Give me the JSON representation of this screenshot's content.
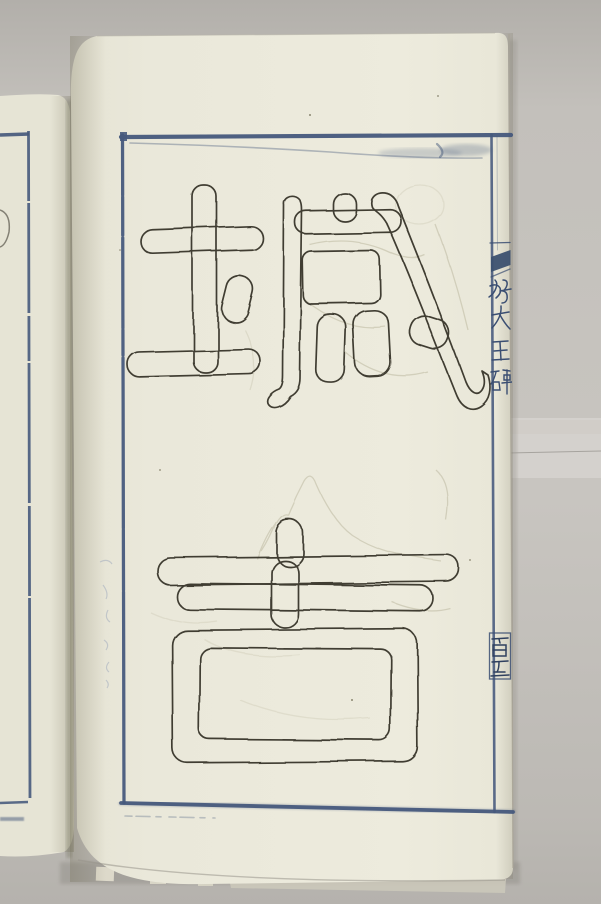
{
  "page": {
    "large_characters": [
      {
        "char": "城"
      },
      {
        "char": "吉"
      }
    ],
    "large_characters_text": "城吉",
    "margin_strip": {
      "title_text": "好大王碑",
      "title_chars": [
        "好",
        "大",
        "王",
        "碑"
      ],
      "page_number_text": "百五",
      "page_number_chars": [
        "百",
        "五"
      ]
    }
  },
  "colors": {
    "backdrop_gray": "#c6c3be",
    "backdrop_band": "#d5d2cd",
    "paper_cream": "#ebe9db",
    "left_page_cream": "#e6e4d5",
    "frame_blue": "#46597c",
    "margin_blue": "#3a4e72",
    "page_number_ink": "#2f405f",
    "outline_ink": "#413e33",
    "pencil_gray": "#bdb9a1",
    "gutter_scribble_blue": "#a9b2c0"
  }
}
